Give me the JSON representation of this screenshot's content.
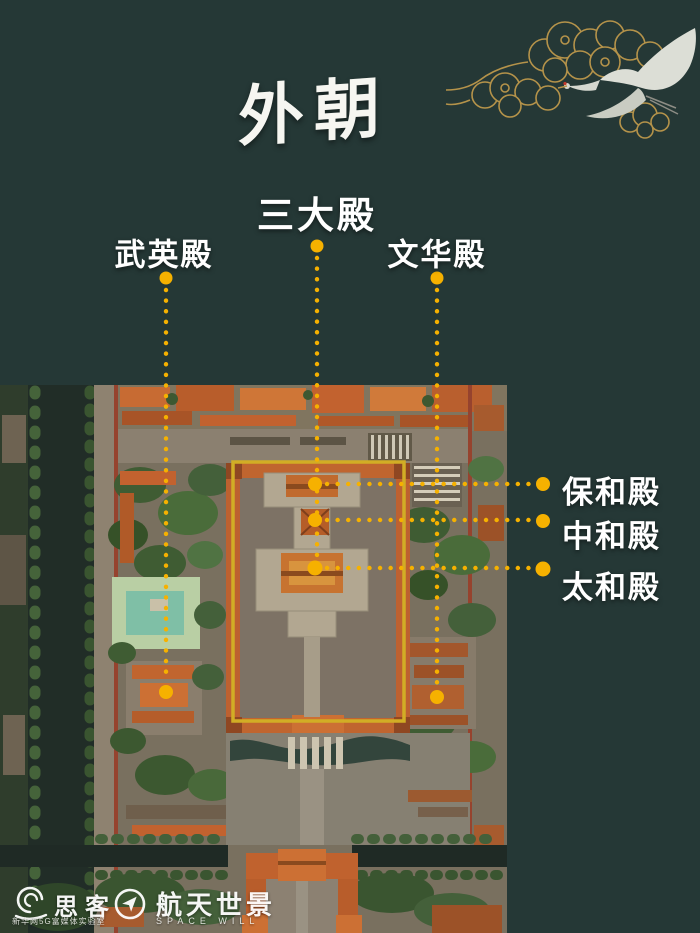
{
  "background_color": "#253836",
  "title": {
    "text": "外朝"
  },
  "decoration": {
    "gold_color": "#b5934a",
    "crane_color": "#dcded6"
  },
  "annotations": {
    "dot_color": "#f6b100",
    "box_color": "#d2ad25",
    "labels": [
      {
        "id": "sandadian",
        "text": "三大殿"
      },
      {
        "id": "wuyingdian",
        "text": "武英殿"
      },
      {
        "id": "wenhuadian",
        "text": "文华殿"
      },
      {
        "id": "baohedian",
        "text": "保和殿"
      },
      {
        "id": "zhonghedian",
        "text": "中和殿"
      },
      {
        "id": "taihedian",
        "text": "太和殿"
      }
    ]
  },
  "footer": {
    "sike": {
      "name": "思客",
      "subtitle": "新华网5G富媒体实验室"
    },
    "spacewill": {
      "name": "航天世景",
      "subtitle": "SPACE WILL"
    }
  }
}
